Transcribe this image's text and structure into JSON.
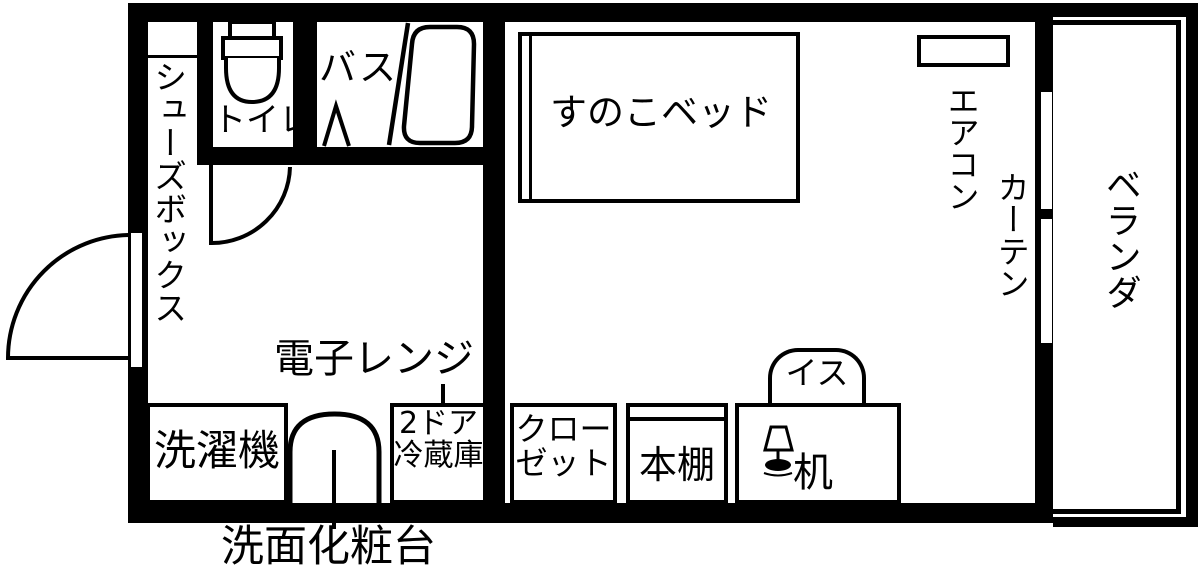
{
  "labels": {
    "shoes_box": "シューズボックス",
    "toilet": "トイレ",
    "bath": "バス",
    "bed": "すのこベッド",
    "aircon": "エアコン",
    "curtain": "カーテン",
    "veranda": "ベランダ",
    "microwave": "電子レンジ",
    "washing_machine": "洗濯機",
    "fridge": {
      "line1": "2ドア",
      "line2": "冷蔵庫"
    },
    "closet": {
      "line1": "クロー",
      "line2": "ゼット"
    },
    "bookshelf": "本棚",
    "chair": "イス",
    "desk": "机",
    "vanity": "洗面化粧台"
  },
  "icons": [
    {
      "name": "toilet-icon"
    },
    {
      "name": "bathtub-icon"
    },
    {
      "name": "bath-door-line"
    },
    {
      "name": "door-swing-arc-entrance"
    },
    {
      "name": "door-swing-arc-toilet"
    },
    {
      "name": "washbasin-arch"
    },
    {
      "name": "desk-lamp-icon"
    },
    {
      "name": "window-glyph"
    }
  ],
  "colors": {
    "wall": "#000000",
    "background": "#ffffff",
    "text": "#000000"
  }
}
